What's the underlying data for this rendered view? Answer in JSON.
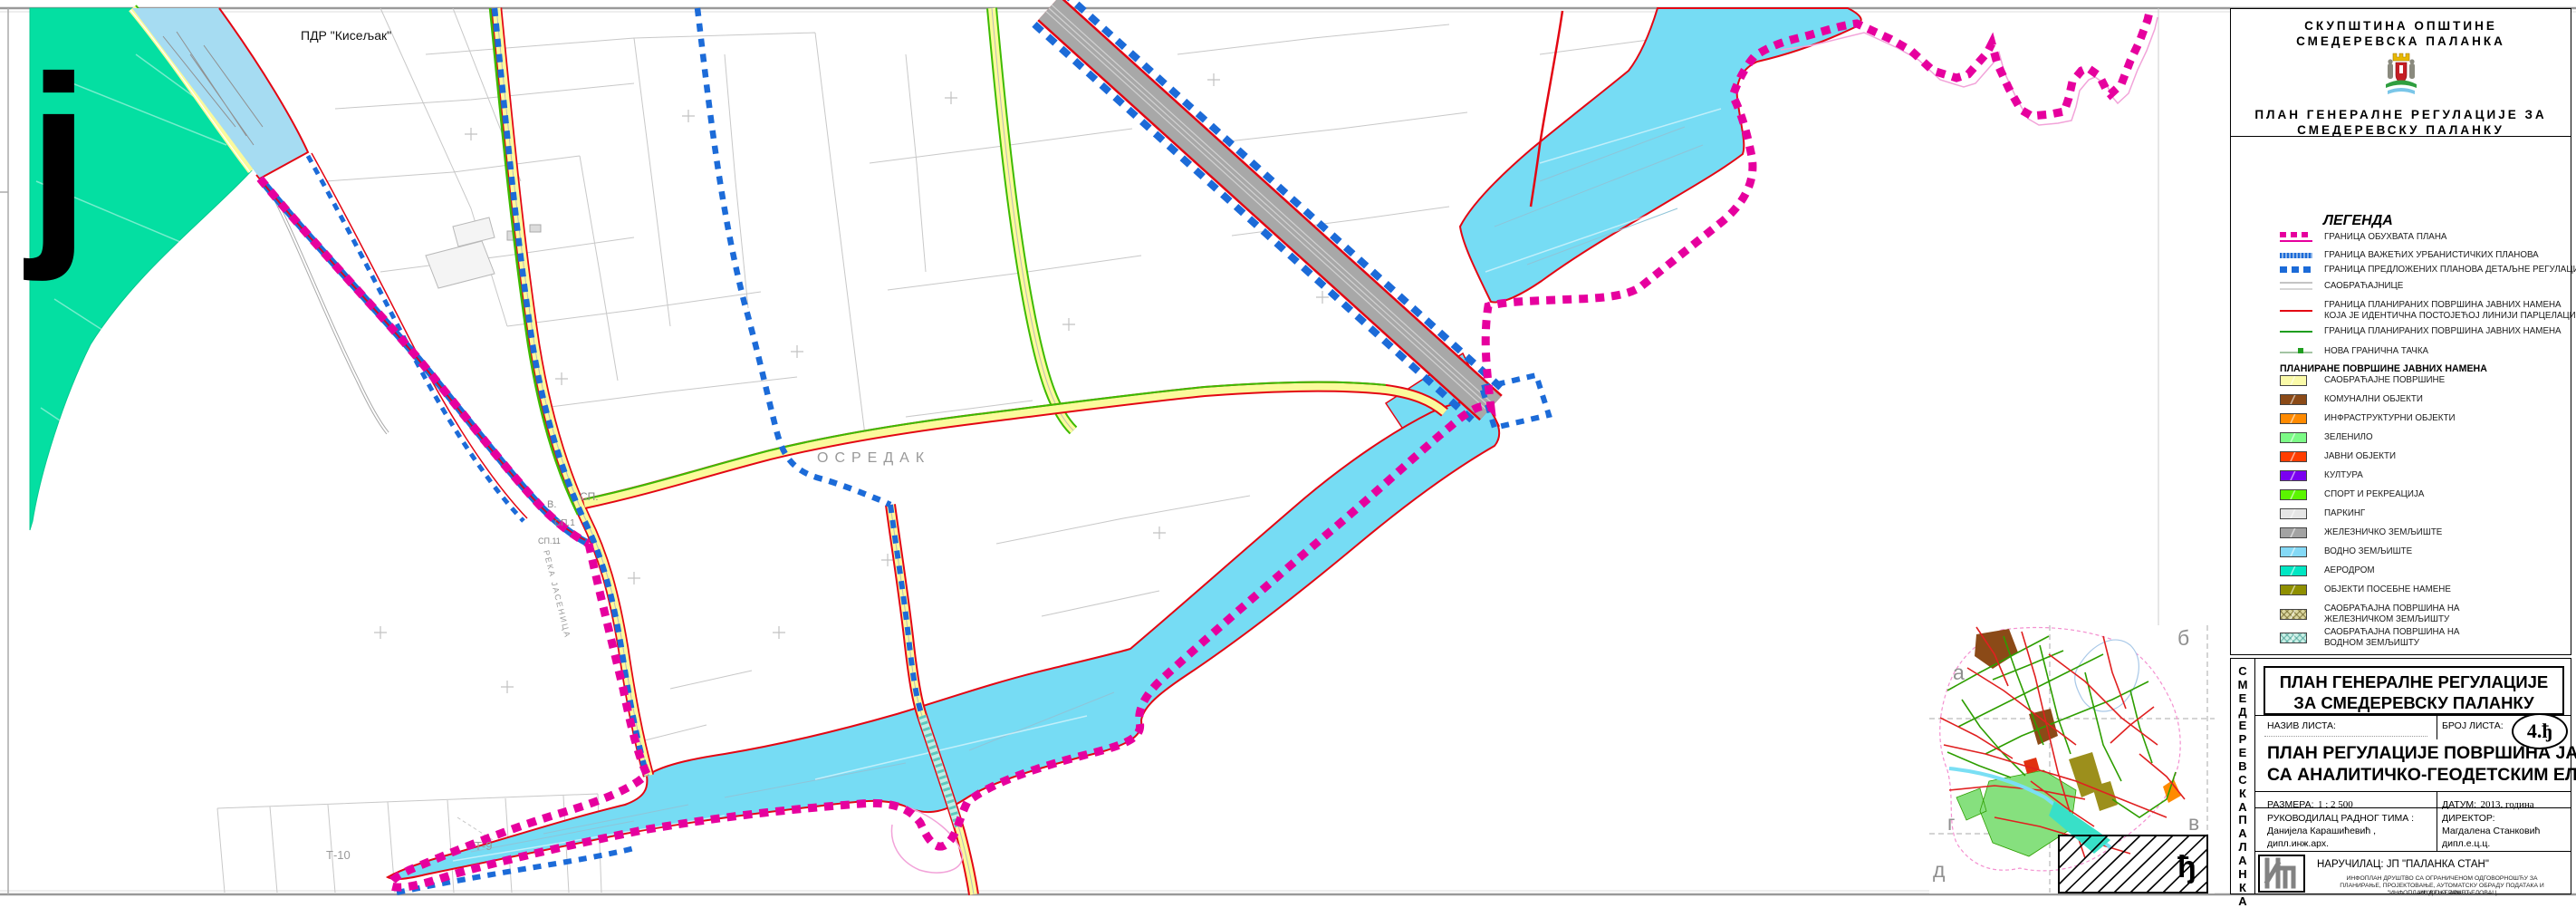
{
  "header": {
    "org_line1": "СКУПШТИНА ОПШТИНЕ",
    "org_line2": "СМЕДЕРЕВСКА ПАЛАНКА",
    "plan_line1": "ПЛАН ГЕНЕРАЛНЕ РЕГУЛАЦИЈЕ ЗА",
    "plan_line2": "СМЕДЕРЕВСКУ ПАЛАНКУ"
  },
  "legend": {
    "title": "ЛЕГЕНДА",
    "boundary_items": [
      {
        "symbol": "magenta-dashed-line",
        "label": "ГРАНИЦА ОБУХВАТА ПЛАНА",
        "color": "#E6009E"
      },
      {
        "symbol": "blue-hatched-line",
        "label": "ГРАНИЦА ВАЖЕЋИХ УРБАНИСТИЧКИХ ПЛАНОВА",
        "color": "#1C6BD8"
      },
      {
        "symbol": "blue-dashed-line",
        "label": "ГРАНИЦА ПРЕДЛОЖЕНИХ ПЛАНОВА ДЕТАЉНЕ РЕГУЛАЦИЈЕ",
        "color": "#1C6BD8"
      },
      {
        "symbol": "gray-double-line",
        "label": "САОБРАЋАЈНИЦЕ",
        "color": "#C9C9C9"
      },
      {
        "symbol": "red-line",
        "label": "ГРАНИЦА ПЛАНИРАНИХ ПОВРШИНА  ЈАВНИХ НАМЕНА",
        "label2": "КОЈА ЈЕ ИДЕНТИЧНА ПОСТОЈЕЋОЈ ЛИНИЈИ ПАРЦЕЛАЦИЈЕ",
        "color": "#E30613"
      },
      {
        "symbol": "green-line",
        "label": "ГРАНИЦА ПЛАНИРАНИХ ПОВРШИНА  ЈАВНИХ НАМЕНА",
        "color": "#1F9E1F"
      },
      {
        "symbol": "boundary-point",
        "label": "НОВА ГРАНИЧНА ТАЧКА",
        "color": "#1F9E1F"
      }
    ],
    "areas_title": "ПЛАНИРАНЕ ПОВРШИНЕ ЈАВНИХ НАМЕНА",
    "area_items": [
      {
        "label": "САОБРАЋАЈНЕ ПОВРШИНЕ",
        "color": "#FAFAA8"
      },
      {
        "label": "КОМУНАЛНИ ОБЈЕКТИ",
        "color": "#8B4A17"
      },
      {
        "label": "ИНФРАСТРУКТУРНИ ОБЈЕКТИ",
        "color": "#FF8A00"
      },
      {
        "label": "ЗЕЛЕНИЛО",
        "color": "#7CFA86"
      },
      {
        "label": "ЈАВНИ ОБЈЕКТИ",
        "color": "#FF3D00"
      },
      {
        "label": "КУЛТУРА",
        "color": "#7B00F0"
      },
      {
        "label": "СПОРТ И РЕКРЕАЦИЈА",
        "color": "#5BF500"
      },
      {
        "label": "ПАРКИНГ",
        "color": "#E6E6E6"
      },
      {
        "label": "ЖЕЛЕЗНИЧКО ЗЕМЉИШТЕ",
        "color": "#A3A3A3"
      },
      {
        "label": "ВОДНО ЗЕМЉИШТЕ",
        "color": "#84D9F6"
      },
      {
        "label": "АЕРОДРОМ",
        "color": "#00E6C3"
      },
      {
        "label": "ОБЈЕКТИ ПОСЕБНЕ НАМЕНЕ",
        "color": "#8F8F00"
      },
      {
        "label": "САОБРАЋАЈНА ПОВРШИНА НА",
        "label2": "ЖЕЛЕЗНИЧКОМ ЗЕМЉИШТУ",
        "color": "#DBD6A0",
        "hatched": true
      },
      {
        "label": "САОБРАЋАЈНА ПОВРШИНА НА",
        "label2": "ВОДНОМ ЗЕМЉИШТУ",
        "color": "#C9EFE5",
        "hatched": true
      }
    ]
  },
  "title_block": {
    "vertical_text_1": "СМЕДЕРЕВСКА",
    "vertical_text_2": "ПАЛАНКА",
    "plan_title_line1": "ПЛАН ГЕНЕРАЛНЕ РЕГУЛАЦИЈЕ",
    "plan_title_line2": "ЗА СМЕДЕРЕВСКУ  ПАЛАНКУ",
    "sheet_name_label": "НАЗИВ ЛИСТА:",
    "sheet_number_label": "БРОЈ ЛИСТА:",
    "sheet_number": "4.ђ",
    "sheet_title_line1": "ПЛАН РЕГУЛАЦИЈЕ ПОВРШИНА ЈАВНЕ НАМЕНЕ",
    "sheet_title_line2": "СА АНАЛИТИЧКО-ГЕОДЕТСКИМ ЕЛЕМЕНТИМА",
    "scale_label": "РАЗМЕРА:",
    "scale_value": "1 : 2 500",
    "date_label": "ДАТУМ:",
    "date_value": "2013. година",
    "team_lead_label": "РУКОВОДИЛАЦ РАДНОГ ТИМА :",
    "team_lead_name": "Данијела Карашићевић ,",
    "team_lead_title": "дипл.инж.арх.",
    "director_label": "ДИРЕКТОР:",
    "director_name": "Магдалена Станковић дипл.е.ц.ц.",
    "client_line": "НАРУЧИЛАЦ: ЈП \"ПАЛАНКА СТАН\"",
    "company_line1": "ИНФОПЛАН ДРУШТВО СА ОГРАНИЧЕНОМ ОДГОВОРНОШЋУ ЗА",
    "company_line2": "ПЛАНИРАЊЕ, ПРОЈЕКТОВАЊЕ, АУТОМАТСКУ ОБРАДУ ПОДАТАКА И ИНЖЕЊЕРИНГ",
    "company_line3": "\"ИНФОПЛАН\" Д.О.О. АРАНЂЕЛОВАЦ"
  },
  "map_labels": {
    "pdr_kiseljak": "ПДР \"Кисељак\"",
    "osredak": "ОСРЕДАК",
    "reka_jasenica": "РЕКА ЈАСЕНИЦА",
    "big_letter": "ј",
    "v_label": "В.",
    "sp_label": "СП.",
    "sp1_label": "СП.1",
    "sp11_label": "СП.11",
    "t10_label": "Т-10",
    "t9_label": "Т-9"
  },
  "inset": {
    "letter_a": "а",
    "letter_b": "б",
    "letter_v": "в",
    "letter_g": "г",
    "letter_d": "д",
    "sheet_letter": "ђ"
  },
  "colors": {
    "plan_boundary_magenta": "#E6009E",
    "urban_plans_blue": "#1C6BD8",
    "public_boundary_red": "#E30613",
    "public_boundary_green": "#1F9E1F",
    "water": "#76DCF4",
    "airport_teal": "#04DFA2",
    "road_fill_yellow": "#FBFA9C",
    "railway_gray": "#A3A3A3"
  }
}
